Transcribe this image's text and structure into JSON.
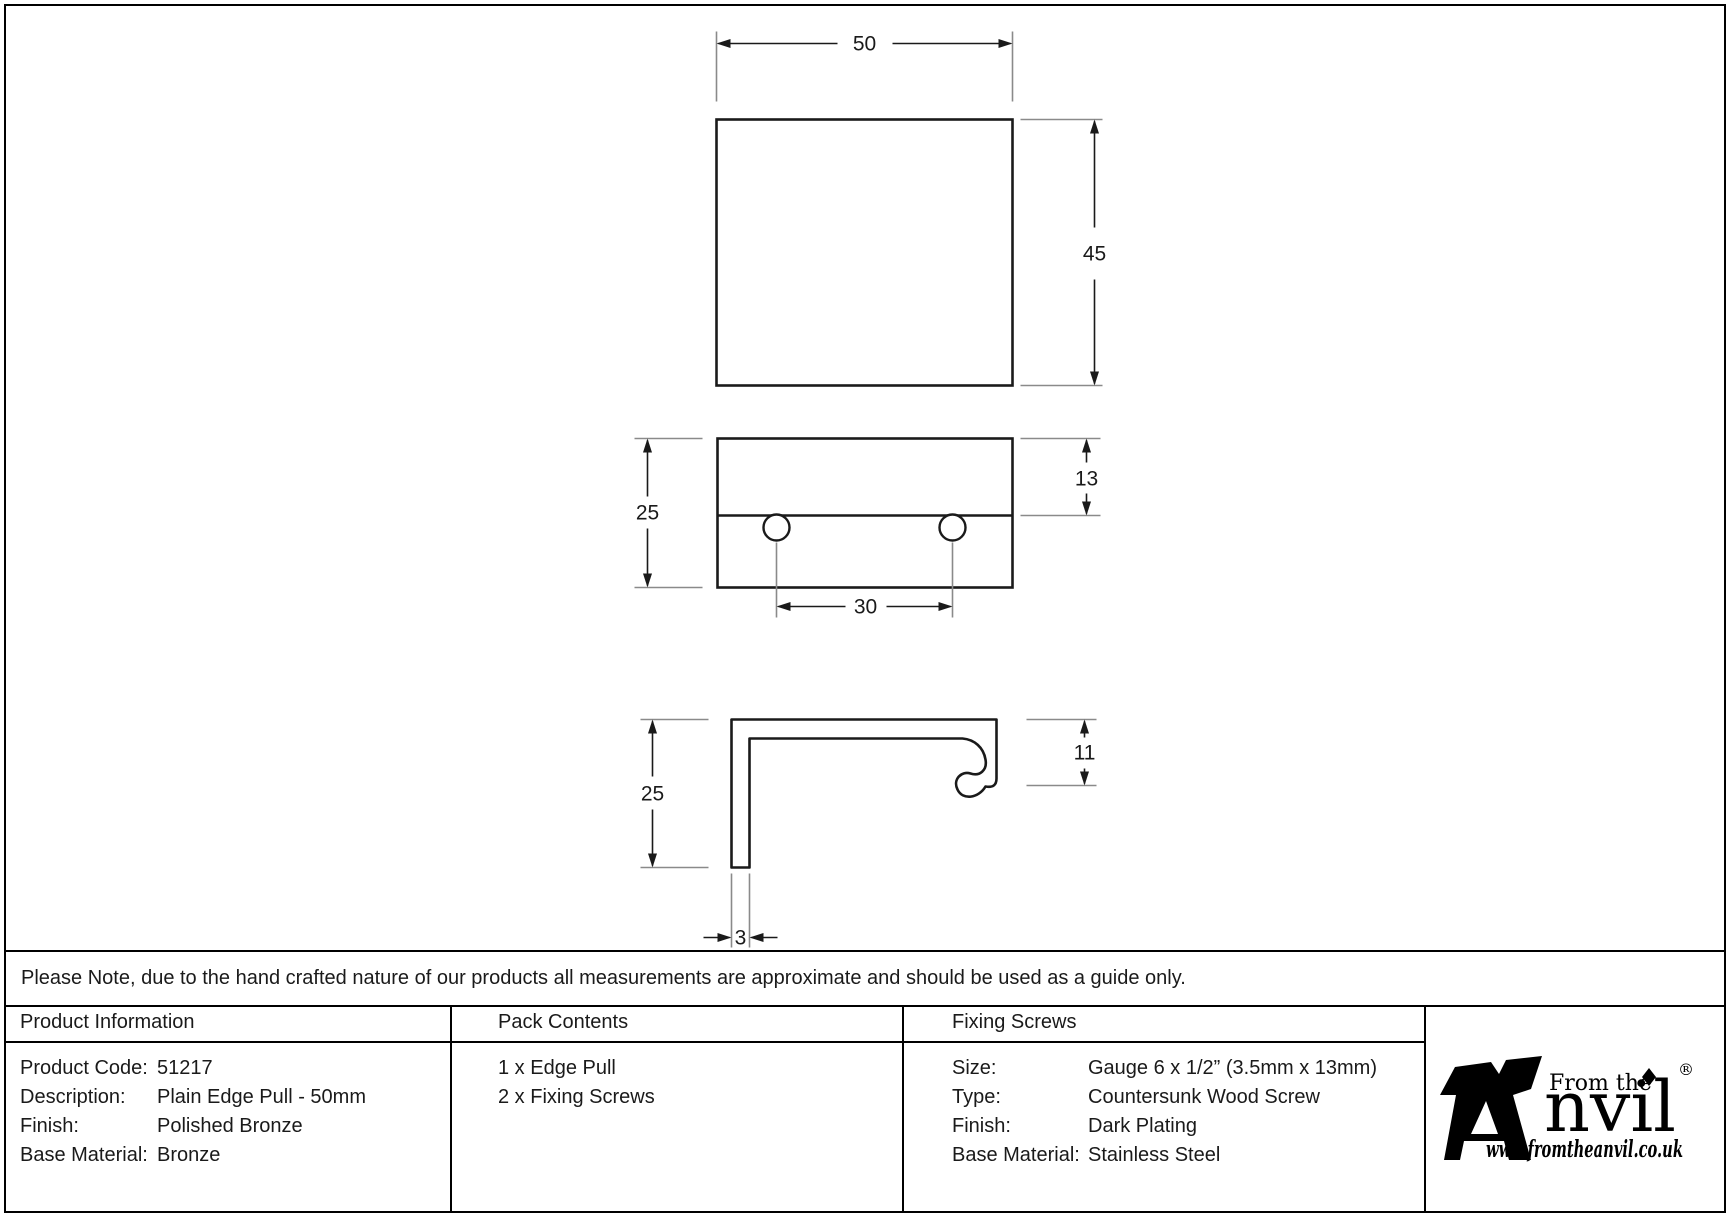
{
  "note": {
    "text": "Please Note, due to the hand crafted nature of our products all measurements are approximate and should be used as a guide only."
  },
  "drawing": {
    "top_view": {
      "width": "50",
      "height": "45"
    },
    "front_view": {
      "height": "25",
      "top_section": "13",
      "hole_spacing": "30"
    },
    "side_view": {
      "height": "25",
      "lip_depth": "11",
      "thickness": "3"
    }
  },
  "table": {
    "product_information": {
      "header": "Product Information",
      "rows": [
        {
          "label": "Product Code:",
          "value": "51217"
        },
        {
          "label": "Description:",
          "value": "Plain Edge Pull - 50mm"
        },
        {
          "label": "Finish:",
          "value": "Polished Bronze"
        },
        {
          "label": "Base Material:",
          "value": "Bronze"
        }
      ]
    },
    "pack_contents": {
      "header": "Pack Contents",
      "items": [
        "1 x Edge Pull",
        "2 x Fixing Screws"
      ]
    },
    "fixing_screws": {
      "header": "Fixing Screws",
      "rows": [
        {
          "label": "Size:",
          "value": "Gauge 6 x 1/2” (3.5mm x 13mm)"
        },
        {
          "label": "Type:",
          "value": "Countersunk Wood Screw"
        },
        {
          "label": "Finish:",
          "value": "Dark Plating"
        },
        {
          "label": "Base Material:",
          "value": "Stainless Steel"
        }
      ]
    }
  },
  "logo": {
    "prefix": "From the",
    "brand": "nvil",
    "registered": "®",
    "url": "www.fromtheanvil.co.uk"
  },
  "colors": {
    "line": "#1a1a1a",
    "extension_line": "#8a8a8a",
    "background": "#ffffff"
  }
}
